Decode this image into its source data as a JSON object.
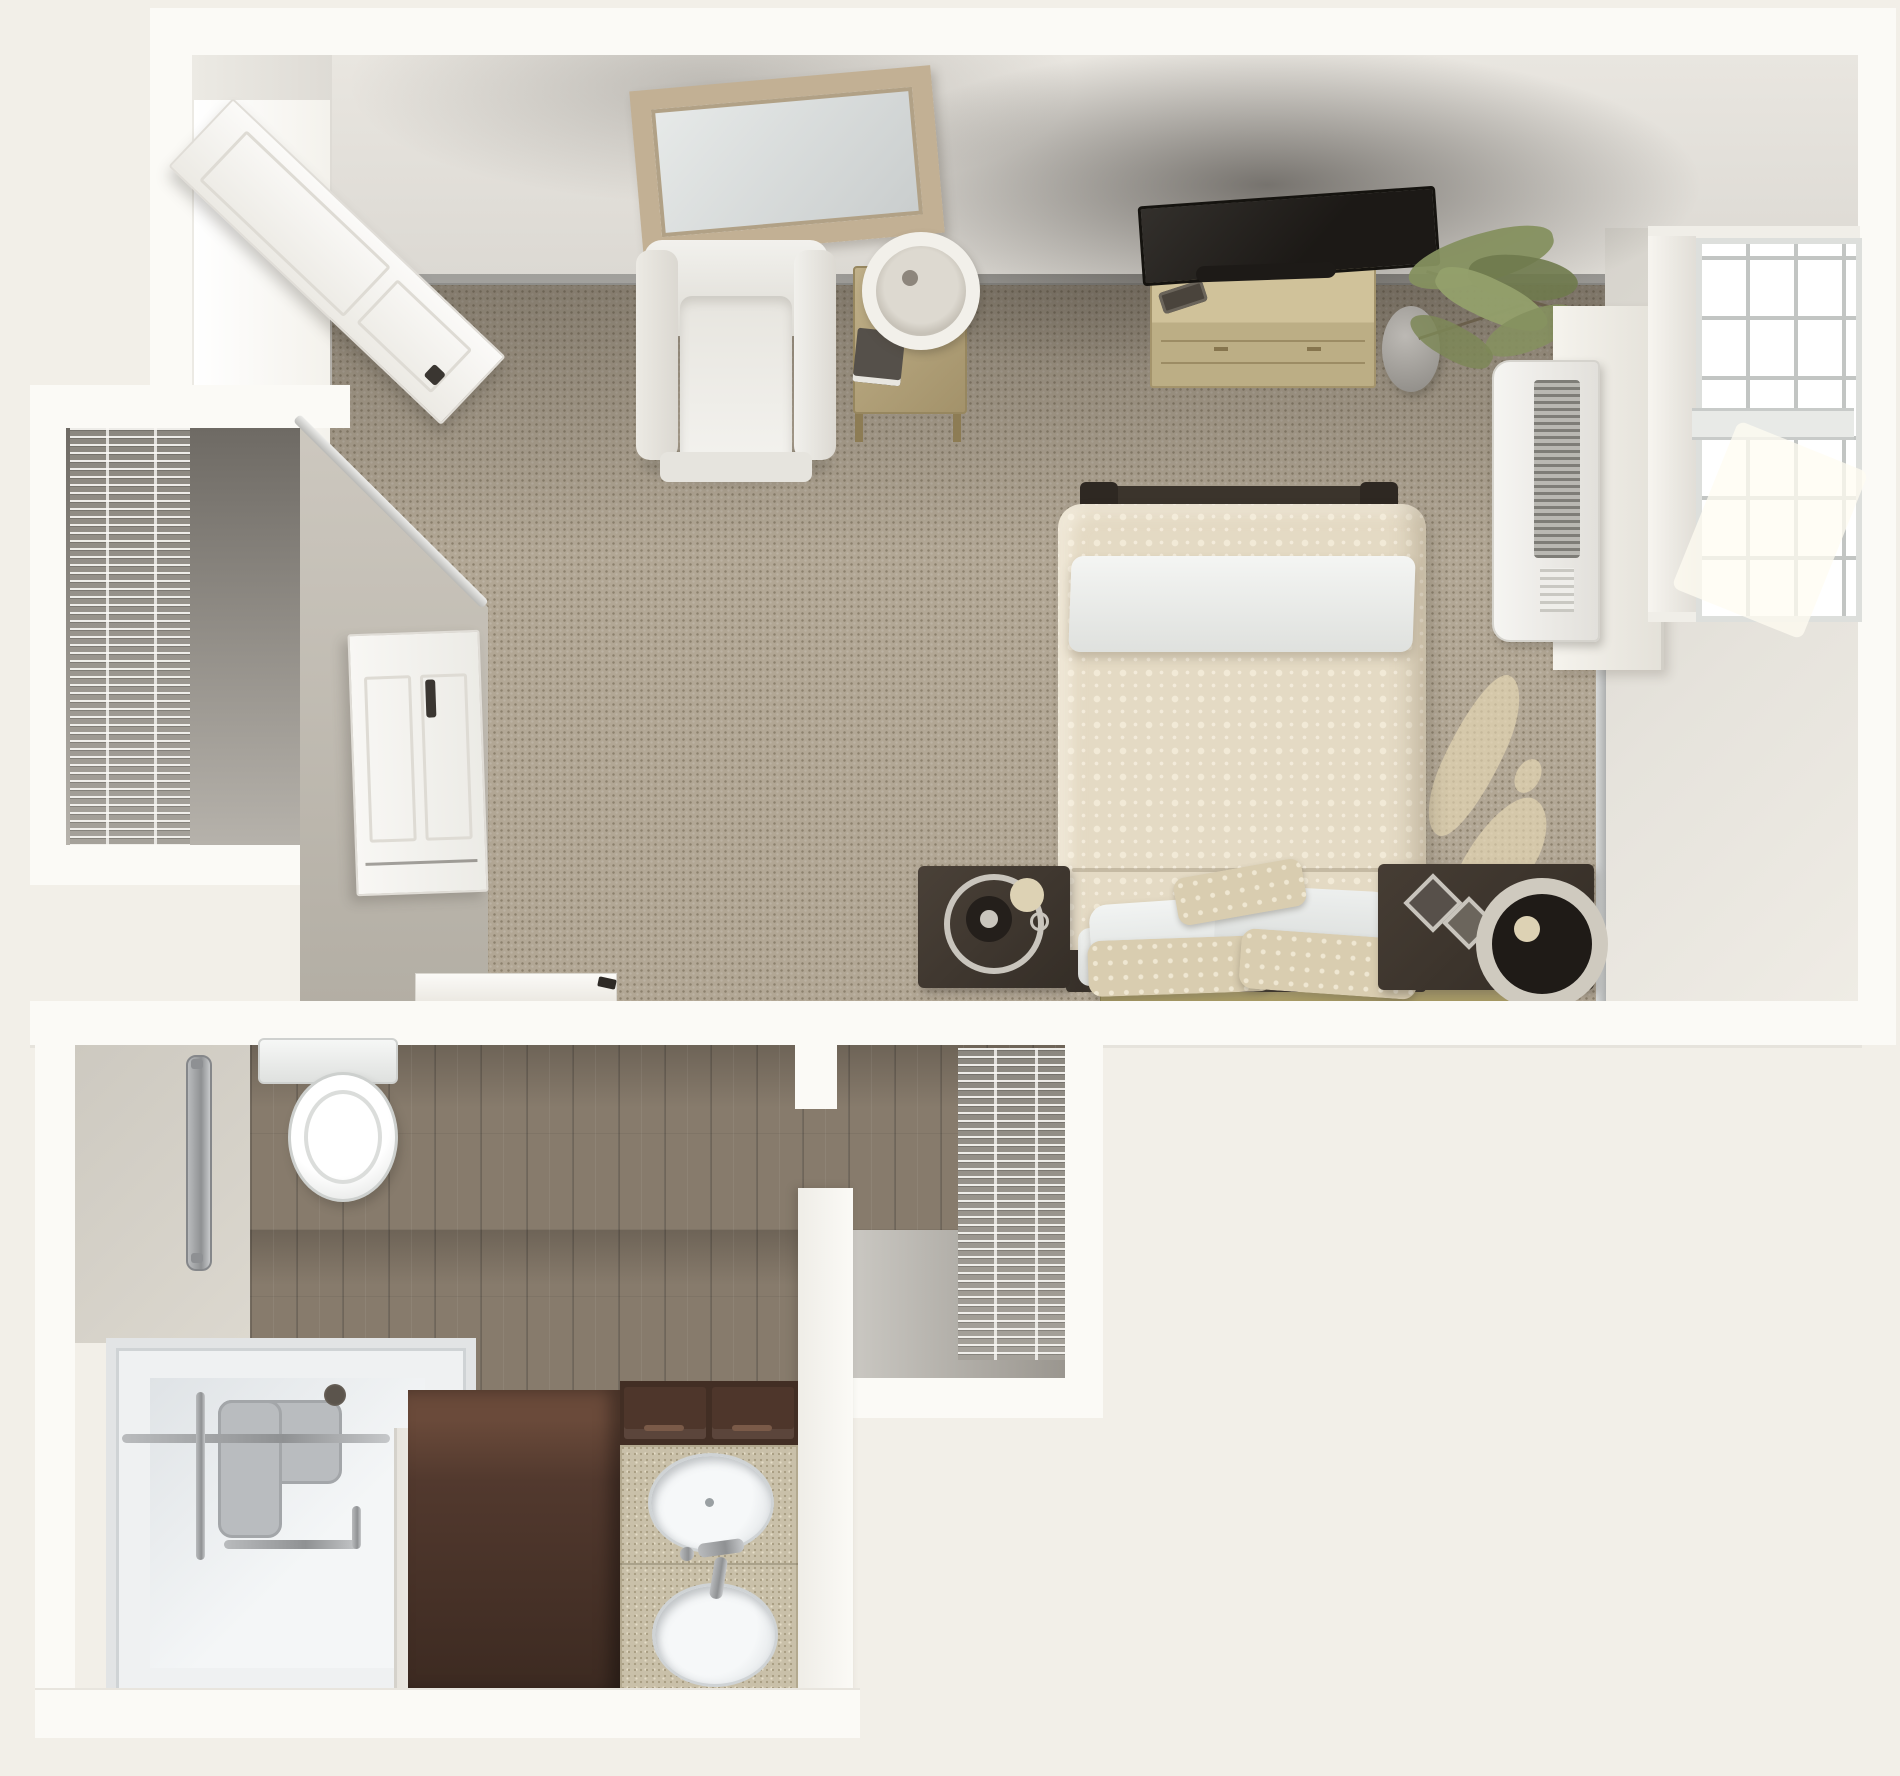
{
  "canvas": {
    "width": 1900,
    "height": 1776,
    "kind": "3d-floor-plan-rendering",
    "unit": "studio-apartment"
  },
  "palette": {
    "bg": "#f2efe8",
    "outerWall": "#fbfaf6",
    "wallFace": "#e2dfd9",
    "baseboard": "#e3e4e2",
    "carpet": "#b2a795",
    "greigeWall": "#c6c1b8",
    "closetFloorDark": "#6e6a64",
    "closetFloorLight": "#b6b2ab",
    "wireBg": "#98948d",
    "doorWhite": "#f7f6f3",
    "doorEdge": "#e0ddd7",
    "handleDark": "#3a3631",
    "chairBody": "#edebe5",
    "tableWood": "#b5a47e",
    "lampRing": "#f2f0ea",
    "mirrorFrame": "#c2b094",
    "mirrorGlass": "#dfe3e2",
    "tvBlack": "#262220",
    "dresserWood": "#c8ba91",
    "plantPot": "#a8a5a0",
    "plantGreen": "#85905f",
    "plantGreenDark": "#6f7a4d",
    "acBody": "#f2f1ee",
    "acVent": "#7e7d77",
    "windowFrame": "#f0eee8",
    "windowMullion": "#c2c5c3",
    "rightWall": "#dcd9d2",
    "chromeTrim": "#c9cbcb",
    "bedFrame": "#3b342c",
    "duvet": "#e4dac4",
    "duvetDot": "#f2ead7",
    "sheetWhite": "#eef0ee",
    "mattressWhite": "#e8eae8",
    "nightstand": "#413931",
    "ringSilver": "#c9c5bd",
    "ringCream": "#ddd2b4",
    "thresholdWood": "#b3a678",
    "bathWallFace": "#cfcbc2",
    "woodFloor": "#877b6c",
    "creamFloor": "#d8d2c4",
    "toiletWhite": "#f2f3f2",
    "showerPan": "#eff1f2",
    "showerSeat": "#b9bcbf",
    "vanityBrown": "#52392e",
    "vanityDark": "#422e24",
    "counterTop": "#c9c0a9",
    "sinkWhite": "#eceff0",
    "sunlight": "rgba(236,221,185,0.6)"
  },
  "rooms": [
    {
      "id": "bedroom-living-area",
      "floor": "carpet"
    },
    {
      "id": "bedroom-closet",
      "floor": "vinyl",
      "storage": "wire-shelving"
    },
    {
      "id": "bathroom",
      "floor": "wood-plank"
    },
    {
      "id": "walk-in-closet",
      "floor": "vinyl",
      "storage": "wire-shelving"
    }
  ],
  "furniture": {
    "bedroom": [
      "entry-door-open",
      "wall-mirror",
      "armchair",
      "side-table",
      "table-lamp",
      "book",
      "flat-screen-tv",
      "media-dresser",
      "remote-control",
      "potted-plant",
      "ac-wall-unit",
      "window-four-sash",
      "bed-with-patterned-duvet",
      "white-sheet-fold",
      "pillows",
      "nightstand-left-with-ring-decor",
      "nightstand-right-with-frames-and-wheel",
      "sliding-barn-door",
      "floor-threshold",
      "sunlight-patches"
    ],
    "bathroom": [
      "toilet",
      "vertical-grab-bar",
      "roll-in-shower",
      "shower-corner-seat",
      "shower-grab-bars",
      "shower-drain",
      "tall-vanity-cabinet",
      "vanity-drawers",
      "double-sink-counter",
      "oval-sink-upper",
      "oval-sink-lower",
      "chrome-faucets",
      "wire-shelving-rack"
    ]
  }
}
